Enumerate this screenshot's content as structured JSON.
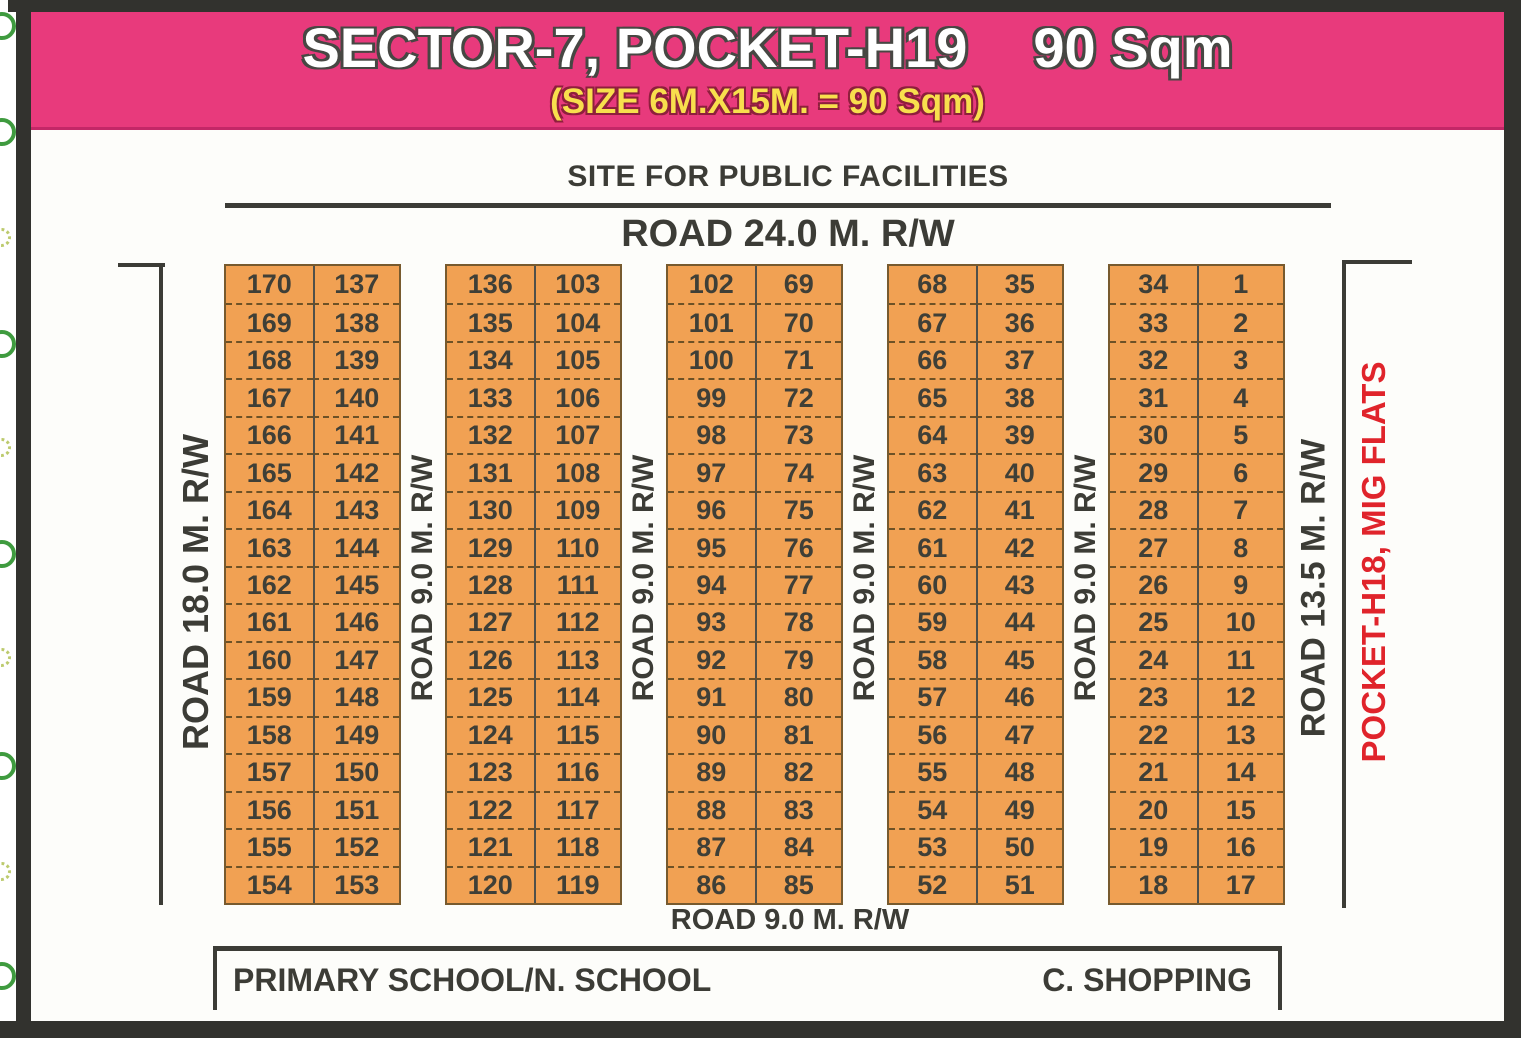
{
  "banner": {
    "title": "SECTOR-7, POCKET-H19",
    "area": "90 Sqm",
    "subtitle": "(SIZE 6M.X15M. = 90 Sqm)"
  },
  "header": {
    "site_label": "SITE FOR PUBLIC FACILITIES",
    "road_top": "ROAD 24.0 M. R/W"
  },
  "roads": {
    "left": "ROAD 18.0 M. R/W",
    "between": "ROAD 9.0 M. R/W",
    "bottom": "ROAD 9.0 M. R/W",
    "right": "ROAD 13.5 M. R/W"
  },
  "side_label": "POCKET-H18, MIG FLATS",
  "footer": {
    "school": "PRIMARY SCHOOL/N. SCHOOL",
    "shopping": "C. SHOPPING"
  },
  "colors": {
    "banner_pink": "#e83a7c",
    "subtitle_yellow": "#f8df4d",
    "plot_orange": "#f1a153",
    "ink": "#3c3c36",
    "pocket_red": "#e0242b"
  },
  "blocks": [
    {
      "left": [
        170,
        169,
        168,
        167,
        166,
        165,
        164,
        163,
        162,
        161,
        160,
        159,
        158,
        157,
        156,
        155,
        154
      ],
      "right": [
        137,
        138,
        139,
        140,
        141,
        142,
        143,
        144,
        145,
        146,
        147,
        148,
        149,
        150,
        151,
        152,
        153
      ]
    },
    {
      "left": [
        136,
        135,
        134,
        133,
        132,
        131,
        130,
        129,
        128,
        127,
        126,
        125,
        124,
        123,
        122,
        121,
        120
      ],
      "right": [
        103,
        104,
        105,
        106,
        107,
        108,
        109,
        110,
        111,
        112,
        113,
        114,
        115,
        116,
        117,
        118,
        119
      ]
    },
    {
      "left": [
        102,
        101,
        100,
        99,
        98,
        97,
        96,
        95,
        94,
        93,
        92,
        91,
        90,
        89,
        88,
        87,
        86
      ],
      "right": [
        69,
        70,
        71,
        72,
        73,
        74,
        75,
        76,
        77,
        78,
        79,
        80,
        81,
        82,
        83,
        84,
        85
      ]
    },
    {
      "left": [
        68,
        67,
        66,
        65,
        64,
        63,
        62,
        61,
        60,
        59,
        58,
        57,
        56,
        55,
        54,
        53,
        52
      ],
      "right": [
        35,
        36,
        37,
        38,
        39,
        40,
        41,
        42,
        43,
        44,
        45,
        46,
        47,
        48,
        49,
        50,
        51
      ]
    },
    {
      "left": [
        34,
        33,
        32,
        31,
        30,
        29,
        28,
        27,
        26,
        25,
        24,
        23,
        22,
        21,
        20,
        19,
        18
      ],
      "right": [
        1,
        2,
        3,
        4,
        5,
        6,
        7,
        8,
        9,
        10,
        11,
        12,
        13,
        14,
        15,
        16,
        17
      ]
    }
  ]
}
